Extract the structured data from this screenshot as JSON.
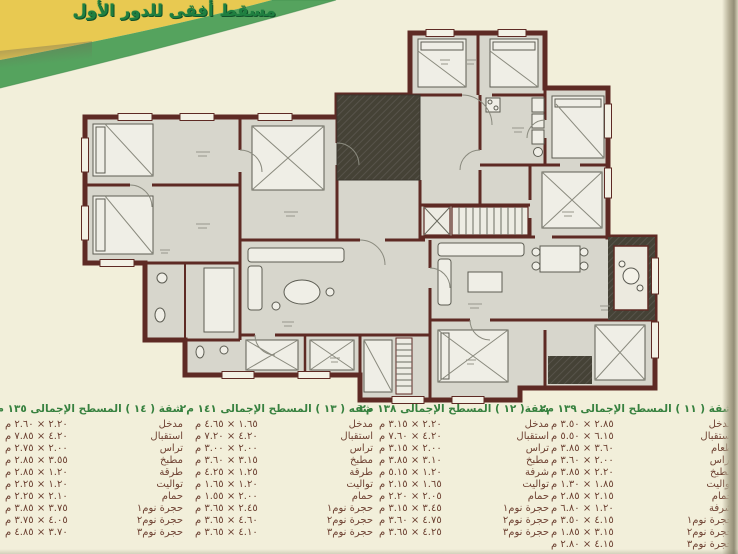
{
  "header": {
    "title": "مسقط أفقى للدور الأول"
  },
  "banner_colors": {
    "yellow": "#e8c951",
    "green": "#55a35e",
    "title_green": "#1f7f40"
  },
  "plan_colors": {
    "wall": "#5e2a24",
    "floor": "#d7d6cc",
    "shaft_hatch": "#454236",
    "paper": "#f2efda"
  },
  "apartments": [
    {
      "title": "شقة ( ١٤ ) المسطح الإجمالى ١٣٥ م٢",
      "rooms": [
        {
          "name": "مدخل",
          "dims": "٢.٢٠ × ٢.٦٠ م"
        },
        {
          "name": "استقبال",
          "dims": "٤.٢٠ × ٧.٨٥ م"
        },
        {
          "name": "تراس",
          "dims": "٢.٠٠ × ٢.٧٥ م"
        },
        {
          "name": "مطبخ",
          "dims": "٣.٥٥ × ٢.٨٥ م"
        },
        {
          "name": "طرقة",
          "dims": "١.٢٠ × ٢.٨٥ م"
        },
        {
          "name": "تواليت",
          "dims": "١.٢٠ × ٢.٢٥ م"
        },
        {
          "name": "حمام",
          "dims": "٢.١٠ × ٢.٢٥ م"
        },
        {
          "name": "حجرة نوم١",
          "dims": "٣.٧٥ × ٣.٨٥ م"
        },
        {
          "name": "حجرة نوم٢",
          "dims": "٤.٠٥ × ٣.٧٥ م"
        },
        {
          "name": "حجرة نوم٣",
          "dims": "٣.٧٠ × ٤.٨٥ م"
        }
      ]
    },
    {
      "title": "شقه ( ١٣ ) المسطح الإجمالى ١٤١ م٢",
      "rooms": [
        {
          "name": "مدخل",
          "dims": "١.٦٥ × ٤.٦٥ م"
        },
        {
          "name": "استقبال",
          "dims": "٤.٢٠ × ٧.٢٠ م"
        },
        {
          "name": "تراس",
          "dims": "٢.٠٠ × ٣.٠٠ م"
        },
        {
          "name": "مطبخ",
          "dims": "٣.١٥ × ٣.٦٠ م"
        },
        {
          "name": "طرقة",
          "dims": "١.٢٥ × ٤.٢٥ م"
        },
        {
          "name": "تواليت",
          "dims": "١.٢٠ × ١.٦٥ م"
        },
        {
          "name": "حمام",
          "dims": "٢.٠٠ × ١.٥٥ م"
        },
        {
          "name": "حجرة نوم١",
          "dims": "٢.٤٥ × ٣.٦٥ م"
        },
        {
          "name": "حجرة نوم٢",
          "dims": "٤.٦٠ × ٣.٦٥ م"
        },
        {
          "name": "حجرة نوم٣",
          "dims": "٤.١٠ × ٣.٦٥ م"
        }
      ]
    },
    {
      "title": "شقة( ١٢ ) المسطح الإجمالى ١٣٨ م٢",
      "rooms": [
        {
          "name": "مدخل",
          "dims": "٢.٢٠ × ٣.١٥ م"
        },
        {
          "name": "استقبال",
          "dims": "٤.٢٠ × ٧.٦٠ م"
        },
        {
          "name": "تراس",
          "dims": "٢.٠٠ × ٣.١٥ م"
        },
        {
          "name": "مطبخ",
          "dims": "٣.١٠ × ٣.٨٥ م"
        },
        {
          "name": "شرفة",
          "dims": "١.٢٠ × ٥.١٥ م"
        },
        {
          "name": "تواليت",
          "dims": "١.٦٥ × ٢.١٥ م"
        },
        {
          "name": "حمام",
          "dims": "٢.٠٥ × ٢.٢٠ م"
        },
        {
          "name": "حجرة نوم١",
          "dims": "٣.٤٥ × ٣.١٥ م"
        },
        {
          "name": "حجرة نوم٢",
          "dims": "٤.٧٥ × ٣.٦٠ م"
        },
        {
          "name": "حجرة نوم٣",
          "dims": "٤.٢٥ × ٣.٦٥ م"
        }
      ]
    },
    {
      "title": "شقة ( ١١ ) المسطح الإجمالى ١٣٩ م٢",
      "rooms": [
        {
          "name": "مدخل",
          "dims": "٢.٨٥ × ٣.٥٠ م"
        },
        {
          "name": "استقبال",
          "dims": "٦.١٥ × ٥.٥٠ م"
        },
        {
          "name": "طعام",
          "dims": "٣.٦٠ × ٣.٨٥ م"
        },
        {
          "name": "تراس",
          "dims": "٢.٠٠ × ٣.٦٠ م"
        },
        {
          "name": "مطبخ",
          "dims": "٢.٢٠ × ٣.٨٥ م"
        },
        {
          "name": "تواليت",
          "dims": "١.٨٥ × ١.٣٠ م"
        },
        {
          "name": "حمام",
          "dims": "٢.١٥ × ٢.٨٥ م"
        },
        {
          "name": "شرفة",
          "dims": "١.٢٠ × ٦.٨٠ م"
        },
        {
          "name": "حجرة نوم١",
          "dims": "٤.١٥ × ٣.٥٠ م"
        },
        {
          "name": "حجرة نوم٢",
          "dims": "٣.١٥ × ١.٨٥ م"
        },
        {
          "name": "حجرة نوم٣",
          "dims": "٤.١٥ × ٢.٨٠ م"
        }
      ]
    }
  ]
}
